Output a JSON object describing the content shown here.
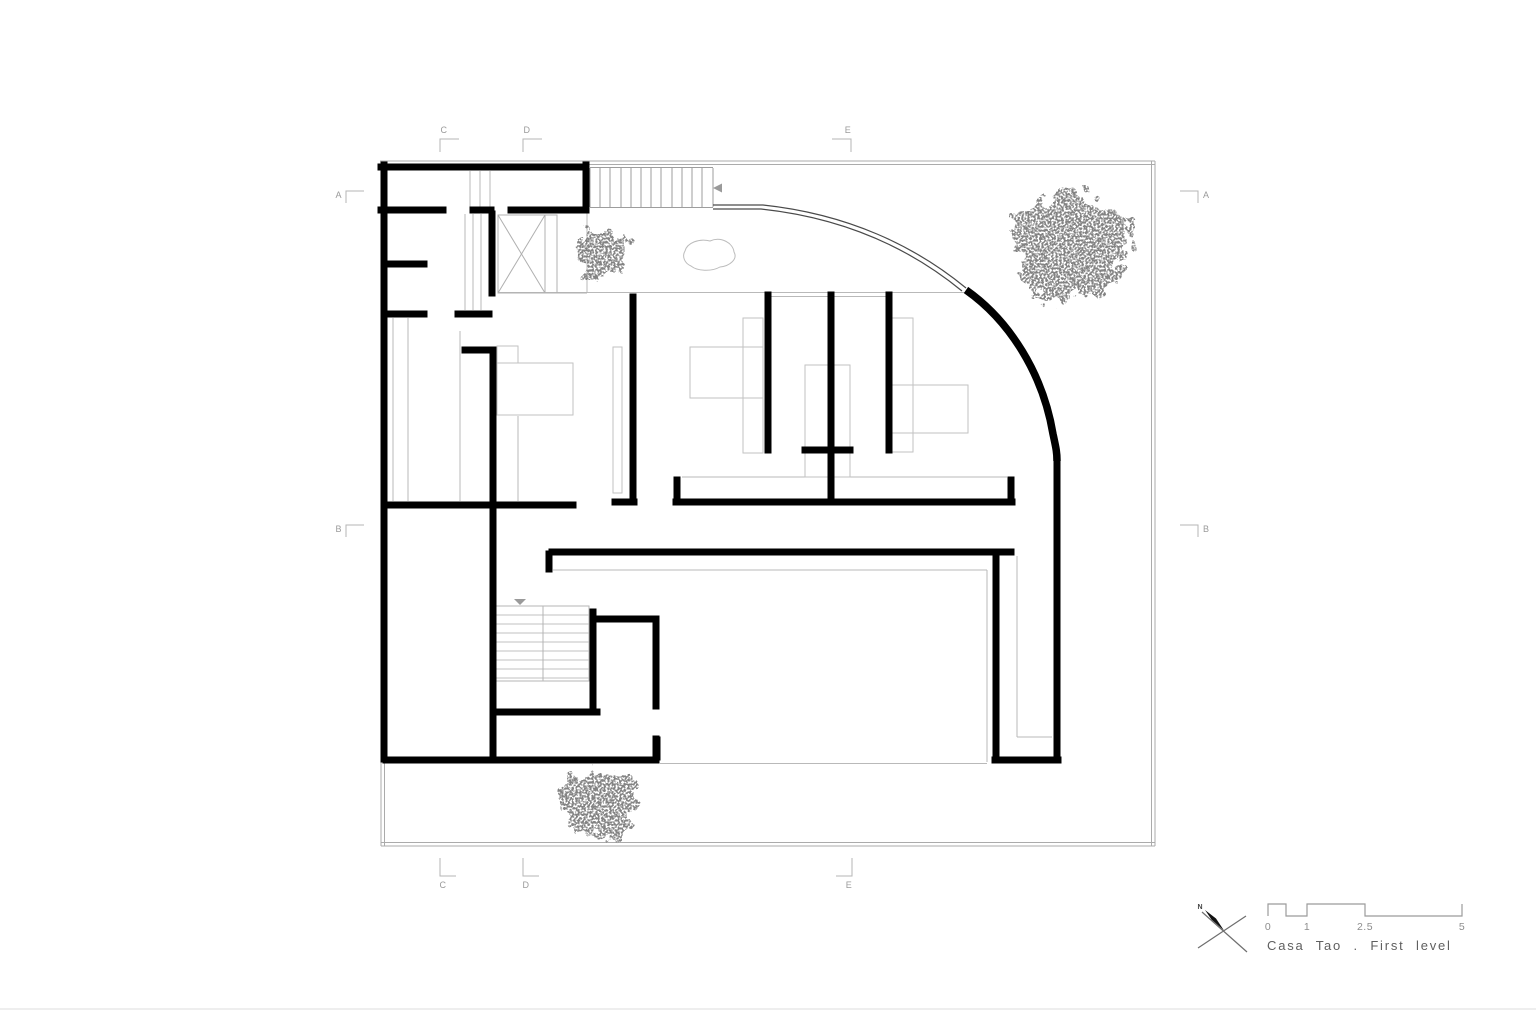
{
  "title": {
    "text": "Casa Tao . First level"
  },
  "grid_markers": {
    "top": [
      "C",
      "D",
      "E"
    ],
    "bottom": [
      "C",
      "D",
      "E"
    ],
    "left": [
      "A",
      "B"
    ],
    "right": [
      "A",
      "B"
    ]
  },
  "north_arrow": {
    "label": "N"
  },
  "scale_bar": {
    "tick_labels": [
      "0",
      "1",
      "2.5",
      "5"
    ]
  },
  "colors": {
    "wall": "#000000",
    "thin_line": "#ababab",
    "detail_line": "#c2c2c2",
    "label": "#9a9a9a",
    "foliage": "#3a3a3a"
  }
}
